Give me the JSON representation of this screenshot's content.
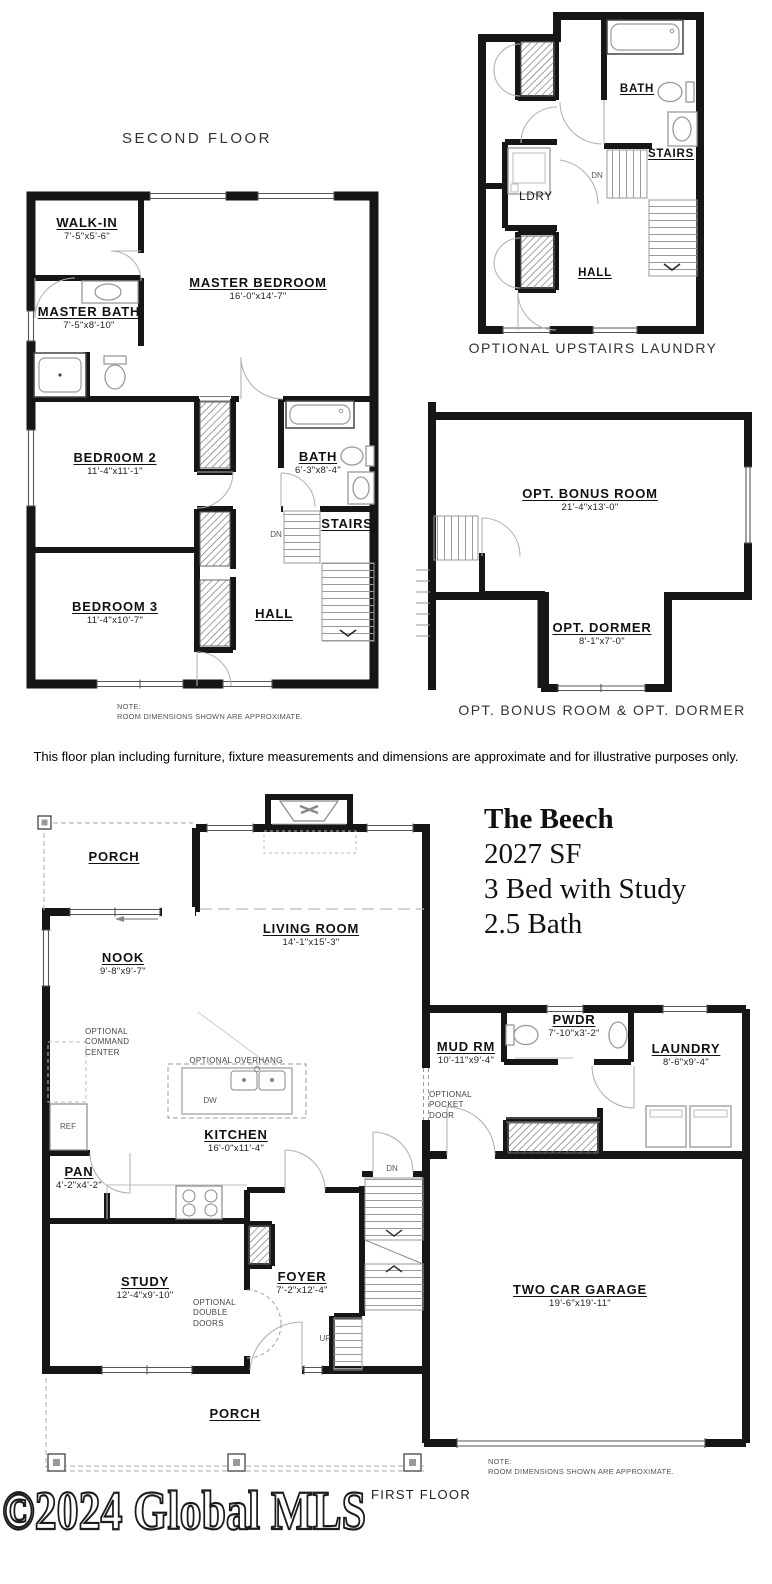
{
  "second_floor": {
    "title": "SECOND FLOOR",
    "rooms": {
      "walk_in": {
        "name": "WALK-IN",
        "dim": "7'-5\"x5'-6\""
      },
      "master_bedroom": {
        "name": "MASTER BEDROOM",
        "dim": "16'-0\"x14'-7\""
      },
      "master_bath": {
        "name": "MASTER BATH",
        "dim": "7'-5\"x8'-10\""
      },
      "bedroom_2": {
        "name": "BEDR0OM 2",
        "dim": "11'-4\"x11'-1\""
      },
      "bath": {
        "name": "BATH",
        "dim": "6'-3\"x8'-4\""
      },
      "bedroom_3": {
        "name": "BEDROOM 3",
        "dim": "11'-4\"x10'-7\""
      },
      "stairs": {
        "name": "STAIRS"
      },
      "hall": {
        "name": "HALL"
      }
    },
    "dn": "DN",
    "note": "NOTE:\nROOM DIMENSIONS SHOWN ARE APPROXIMATE."
  },
  "optional_laundry": {
    "caption": "OPTIONAL UPSTAIRS LAUNDRY",
    "rooms": {
      "bath": {
        "name": "BATH"
      },
      "ldry": {
        "name": "LDRY"
      },
      "stairs": {
        "name": "STAIRS"
      },
      "hall": {
        "name": "HALL"
      }
    },
    "dn": "DN"
  },
  "optional_bonus": {
    "caption": "OPT. BONUS ROOM & OPT. DORMER",
    "rooms": {
      "bonus": {
        "name": "OPT. BONUS ROOM",
        "dim": "21'-4\"x13'-0\""
      },
      "dormer": {
        "name": "OPT. DORMER",
        "dim": "8'-1\"x7'-0\""
      }
    }
  },
  "disclaimer": "This floor plan including furniture, fixture measurements and dimensions are approximate and for illustrative purposes only.",
  "first_floor": {
    "rooms": {
      "porch_top": {
        "name": "PORCH"
      },
      "living_room": {
        "name": "LIVING ROOM",
        "dim": "14'-1\"x15'-3\""
      },
      "nook": {
        "name": "NOOK",
        "dim": "9'-8\"x9'-7\""
      },
      "kitchen": {
        "name": "KITCHEN",
        "dim": "16'-0\"x11'-4\""
      },
      "pantry": {
        "name": "PAN",
        "dim": "4'-2\"x4'-2\""
      },
      "mud_room": {
        "name": "MUD RM",
        "dim": "10'-11\"x9'-4\""
      },
      "powder": {
        "name": "PWDR",
        "dim": "7'-10\"x3'-2\""
      },
      "laundry": {
        "name": "LAUNDRY",
        "dim": "8'-6\"x9'-4\""
      },
      "study": {
        "name": "STUDY",
        "dim": "12'-4\"x9'-10\""
      },
      "foyer": {
        "name": "FOYER",
        "dim": "7'-2\"x12'-4\""
      },
      "garage": {
        "name": "TWO CAR GARAGE",
        "dim": "19'-6\"x19'-11\""
      },
      "porch_bottom": {
        "name": "PORCH"
      }
    },
    "annotations": {
      "command_center": "OPTIONAL\nCOMMAND\nCENTER",
      "overhang": "OPTIONAL OVERHANG",
      "pocket_door": "OPTIONAL\nPOCKET\nDOOR",
      "double_doors": "OPTIONAL\nDOUBLE\nDOORS",
      "ref": "REF",
      "dw": "DW",
      "dn": "DN",
      "up": "UP"
    },
    "note": "NOTE:\nROOM DIMENSIONS SHOWN ARE APPROXIMATE.",
    "label": "FIRST FLOOR"
  },
  "title_block": {
    "plan_name": "The Beech",
    "sqft": "2027 SF",
    "beds": "3 Bed with Study",
    "baths": "2.5 Bath"
  },
  "watermark": "©2024 Global MLS"
}
